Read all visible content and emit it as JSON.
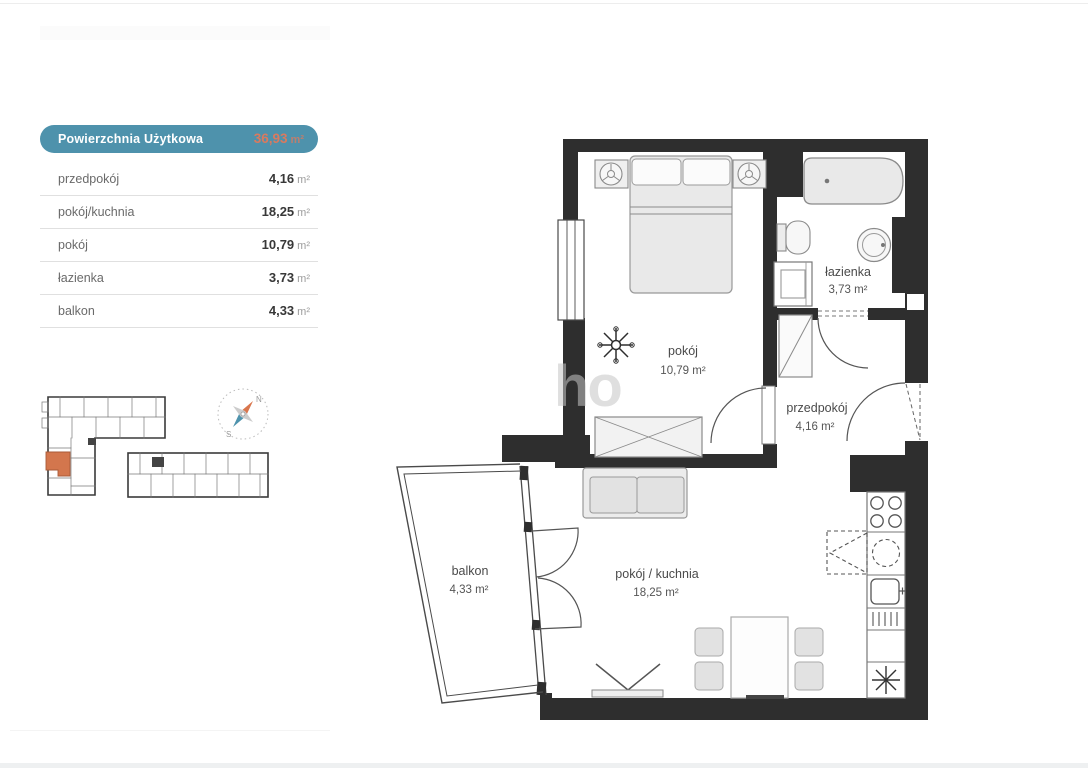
{
  "legend": {
    "header": {
      "label": "Powierzchnia Użytkowa",
      "value": "36,93",
      "unit": "m²"
    },
    "rows": [
      {
        "label": "przedpokój",
        "value": "4,16",
        "unit": "m²"
      },
      {
        "label": "pokój/kuchnia",
        "value": "18,25",
        "unit": "m²"
      },
      {
        "label": "pokój",
        "value": "10,79",
        "unit": "m²"
      },
      {
        "label": "łazienka",
        "value": "3,73",
        "unit": "m²"
      },
      {
        "label": "balkon",
        "value": "4,33",
        "unit": "m²"
      }
    ]
  },
  "plan": {
    "rooms": [
      {
        "name": "pokój",
        "area": "10,79 m²"
      },
      {
        "name": "łazienka",
        "area": "3,73 m²"
      },
      {
        "name": "przedpokój",
        "area": "4,16 m²"
      },
      {
        "name": "pokój / kuchnia",
        "area": "18,25 m²"
      },
      {
        "name": "balkon",
        "area": "4,33 m²"
      }
    ],
    "watermark": "ho"
  },
  "compass": {
    "north": "N",
    "south": "S"
  },
  "colors": {
    "header_bg": "#4E92AC",
    "header_value": "#D97A5F",
    "wall": "#2E2E2E",
    "highlighted_unit": "#D3764D",
    "compass_north": "#D9764D",
    "compass_south": "#4E93AD"
  }
}
